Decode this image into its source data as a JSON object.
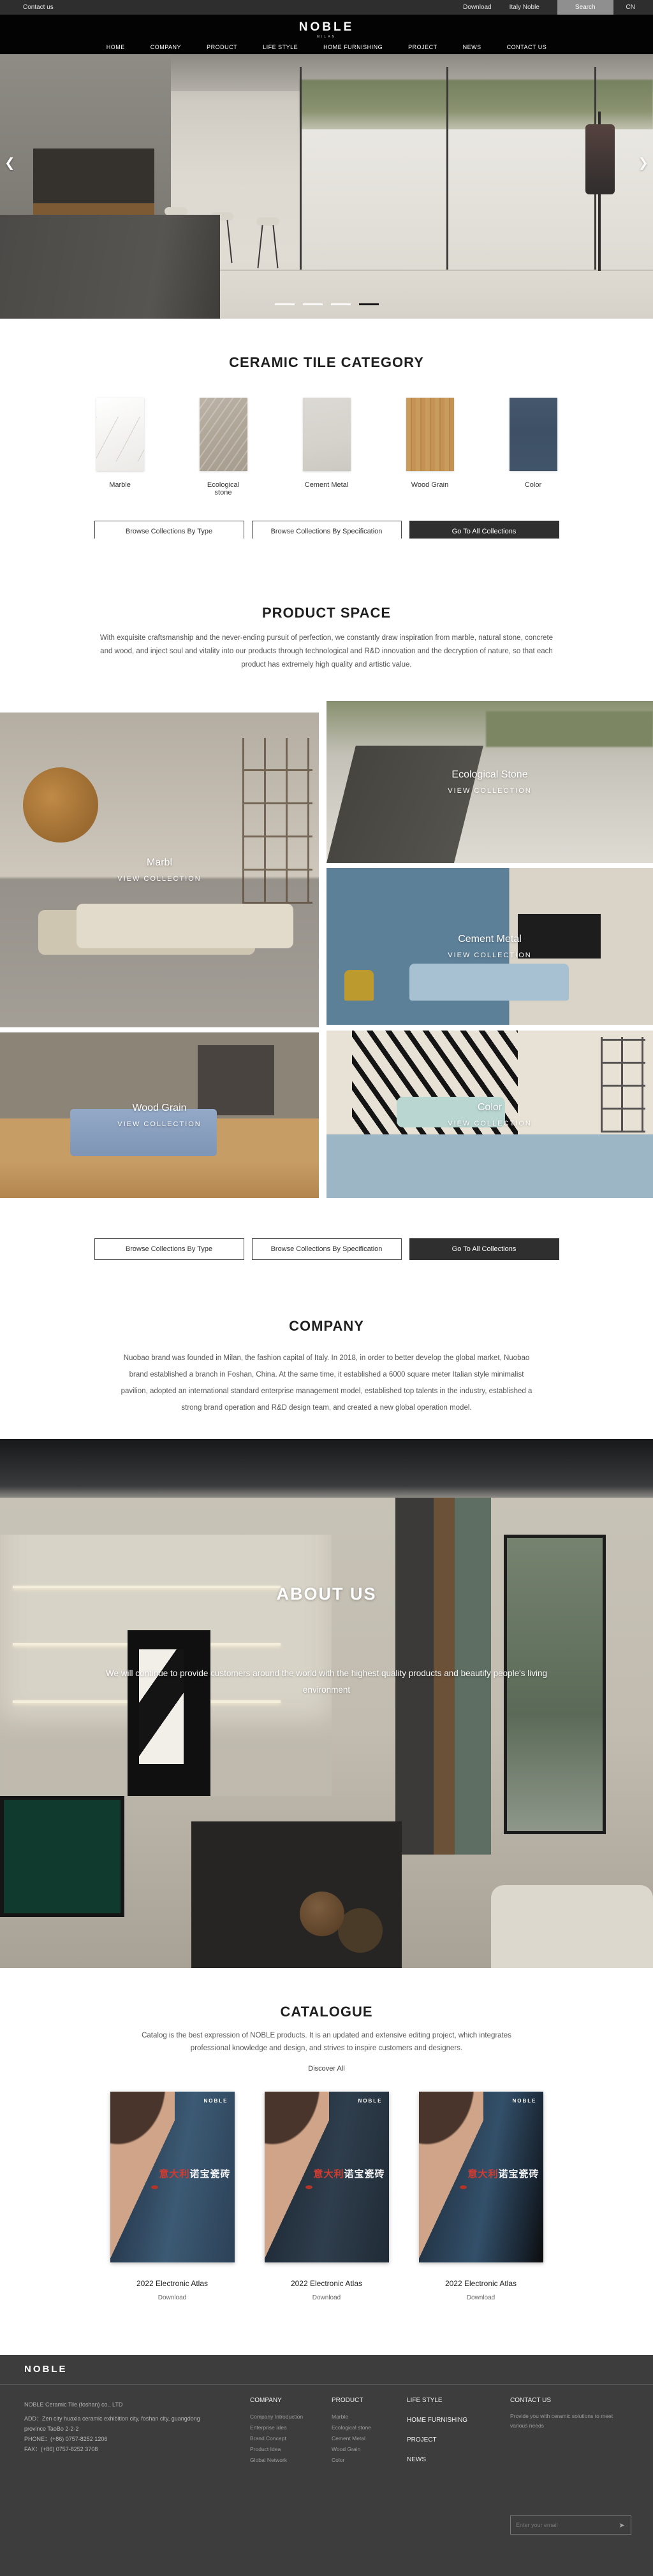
{
  "topbar": {
    "contact": "Contact us",
    "download": "Download",
    "italy_noble": "Italy Noble",
    "search": "Search",
    "lang": "CN"
  },
  "header": {
    "logo": "NOBLE",
    "logo_sub": "MILAN",
    "nav": [
      {
        "label": "HOME"
      },
      {
        "label": "COMPANY"
      },
      {
        "label": "PRODUCT"
      },
      {
        "label": "LIFE STYLE"
      },
      {
        "label": "HOME FURNISHING"
      },
      {
        "label": "PROJECT"
      },
      {
        "label": "NEWS"
      },
      {
        "label": "CONTACT US"
      }
    ]
  },
  "hero": {
    "prev": "❮",
    "next": "❯",
    "slide_count": 4,
    "active_slide": 4
  },
  "category": {
    "title": "CERAMIC TILE CATEGORY",
    "tiles": [
      {
        "label": "Marble"
      },
      {
        "label": "Ecological stone"
      },
      {
        "label": "Cement Metal"
      },
      {
        "label": "Wood Grain"
      },
      {
        "label": "Color"
      }
    ]
  },
  "actions": {
    "by_type": "Browse Collections By Type",
    "by_spec": "Browse Collections By Specification",
    "all": "Go To All Collections"
  },
  "product_space": {
    "title": "PRODUCT SPACE",
    "description": "With exquisite craftsmanship and the never-ending pursuit of perfection, we constantly draw inspiration from marble, natural stone, concrete and wood, and inject soul and vitality into our products through technological and R&D innovation and the decryption of nature, so that each product has extremely high quality and artistic value.",
    "collections": [
      {
        "name": "Marbl",
        "cta": "VIEW COLLECTION"
      },
      {
        "name": "Ecological Stone",
        "cta": "VIEW COLLECTION"
      },
      {
        "name": "Cement Metal",
        "cta": "VIEW COLLECTION"
      },
      {
        "name": "Wood Grain",
        "cta": "VIEW COLLECTION"
      },
      {
        "name": "Color",
        "cta": "VIEW COLLECTION"
      }
    ]
  },
  "company": {
    "title": "COMPANY",
    "description": "Nuobao brand was founded in Milan, the fashion capital of Italy. In 2018, in order to better develop the global market, Nuobao brand established a branch in Foshan, China. At the same time, it established a 6000 square meter Italian style minimalist pavilion, adopted an international standard enterprise management model, established top talents in the industry, established a strong brand operation and R&D design team, and created a new global operation model."
  },
  "about": {
    "title": "ABOUT US",
    "description": "We will continue to provide customers around the world with the highest quality products and beautify people's living environment"
  },
  "catalogue": {
    "title": "CATALOGUE",
    "description": "Catalog is the best expression of NOBLE products. It is an updated and extensive editing project, which integrates professional knowledge and design, and strives to inspire customers and designers.",
    "discover": "Discover All",
    "items": [
      {
        "brand": "NOBLE",
        "title_red": "意大利",
        "title_white": "诺宝瓷砖",
        "name": "2022 Electronic Atlas",
        "download": "Download"
      },
      {
        "brand": "NOBLE",
        "title_red": "意大利",
        "title_white": "诺宝瓷砖",
        "name": "2022 Electronic Atlas",
        "download": "Download"
      },
      {
        "brand": "NOBLE",
        "title_red": "意大利",
        "title_white": "诺宝瓷砖",
        "name": "2022 Electronic Atlas",
        "download": "Download"
      }
    ]
  },
  "footer": {
    "logo": "NOBLE",
    "company_name": "NOBLE Ceramic Tile (foshan) co., LTD",
    "address": "ADD：Zen city huaxia ceramic exhibition city, foshan city, guangdong province TaoBo 2-2-2",
    "phone": "PHONE：(+86) 0757-8252 1206",
    "fax": "FAX：(+86) 0757-8252 3708",
    "columns": [
      {
        "title": "COMPANY",
        "items": [
          "Company Introduction",
          "Enterprise Idea",
          "Brand Concept",
          "Product Idea",
          "Global Network"
        ]
      },
      {
        "title": "PRODUCT",
        "items": [
          "Marble",
          "Ecological stone",
          "Cement Metal",
          "Wood Grain",
          "Color"
        ]
      }
    ],
    "nav_links": [
      "LIFE STYLE",
      "HOME FURNISHING",
      "PROJECT",
      "NEWS"
    ],
    "contact": {
      "title": "CONTACT US",
      "text": "Provide you with ceramic solutions to meet various needs",
      "email_placeholder": "Enter your email",
      "send_icon": "➤"
    }
  },
  "colors": {
    "topbar_bg": "#2e2e2e",
    "header_bg": "#030303",
    "dark_button": "#2f2f2f",
    "footer_bg": "#3d3d3d",
    "carousel_active_dash": "#141414",
    "swatch_marble": "#f4f3f1",
    "swatch_ecological_stone": "#b0a799",
    "swatch_cement_metal": "#d5d2cc",
    "swatch_wood_grain": "#c3924f",
    "swatch_color": "#41546a"
  }
}
